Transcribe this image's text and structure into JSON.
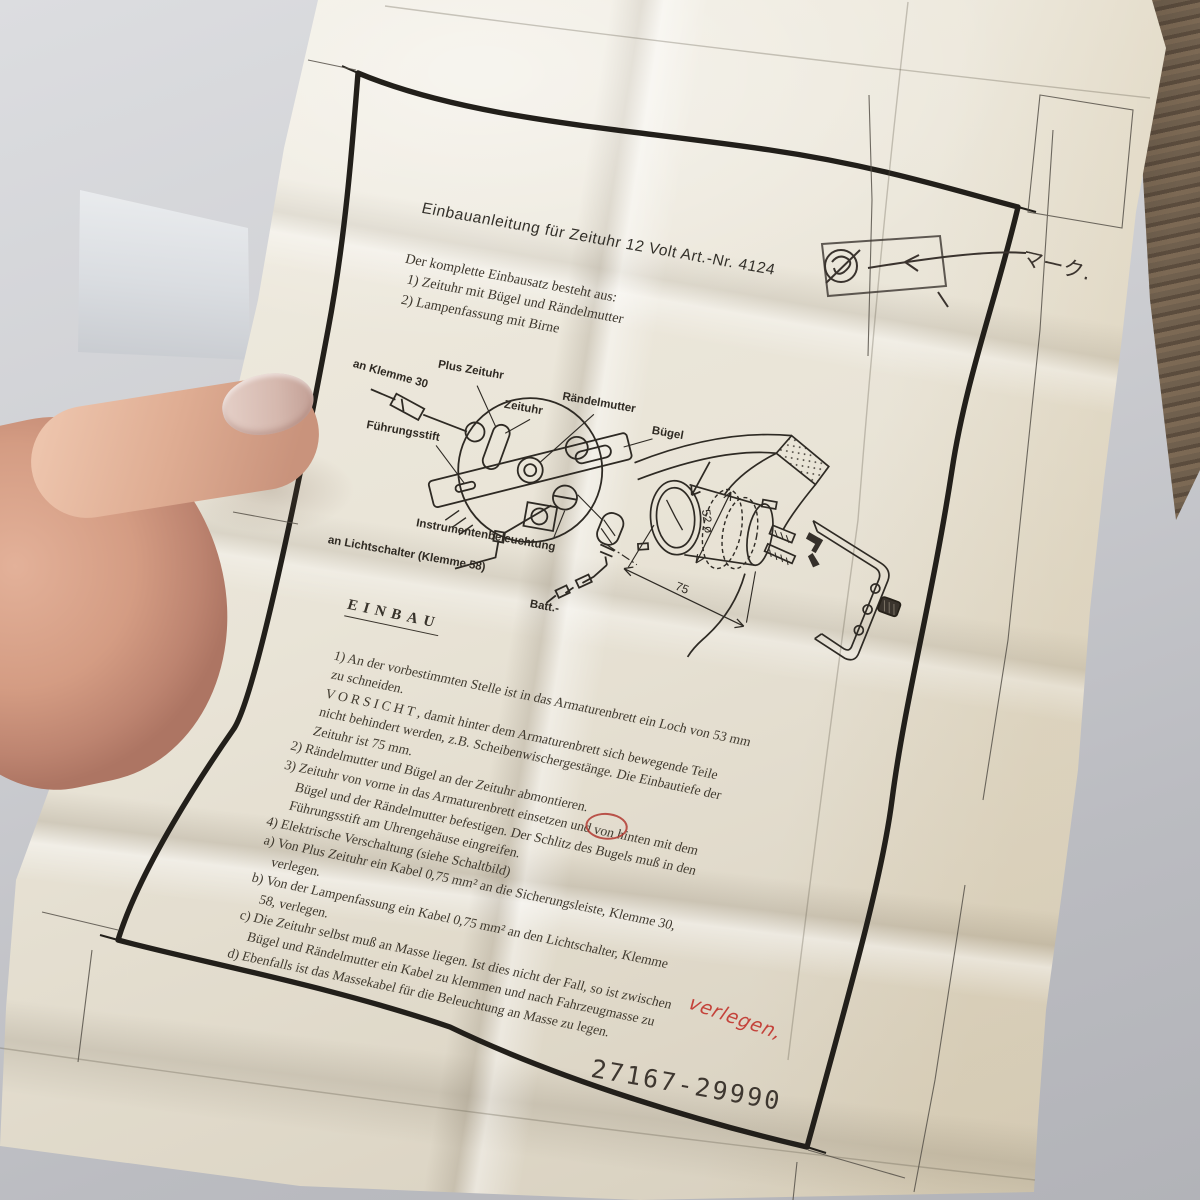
{
  "photo": {
    "background": {
      "wood": "#948b80",
      "wood_dark": "#5d4f42",
      "table": "#cbccd0",
      "shelf_face": "#e4e7ea"
    },
    "paper_color": "#e9e4d7",
    "ink_color": "#353029",
    "red_ink": "#c2403a"
  },
  "doc": {
    "title": "Einbauanleitung für Zeituhr 12 Volt Art.-Nr. 4124",
    "intro_lines": [
      "Der komplette Einbausatz besteht aus:",
      "  1) Zeituhr mit Bügel und Rändelmutter",
      "  2) Lampenfassung mit Birne"
    ],
    "diagram": {
      "labels": {
        "plus_zeituhr": "Plus Zeituhr",
        "an_klemme_30": "an Klemme 30",
        "zeituhr": "Zeituhr",
        "raendelmutter": "Rändelmutter",
        "buegel": "Bügel",
        "fuehrungsstift": "Führungsstift",
        "instrumentenbeleuchtung": "Instrumentenbeleuchtung",
        "an_lichtschalter": "an Lichtschalter (Klemme 58)",
        "batt": "Batt.-"
      },
      "dim_diameter": "52 ø",
      "dim_depth": "75"
    },
    "einbau": {
      "heading": "EINBAU",
      "lines": [
        "1) An der vorbestimmten Stelle ist in das Armaturenbrett ein Loch von 53 mm",
        "     zu schneiden.",
        "     V O R S I C H T , damit hinter dem Armaturenbrett sich bewegende Teile",
        "     nicht behindert werden, z.B. Scheibenwischergestänge. Die Einbautiefe der",
        "     Zeituhr ist 75 mm.",
        "2) Rändelmutter und Bügel an der Zeituhr abmontieren.",
        "3) Zeituhr von vorne in das Armaturenbrett einsetzen und von hinten mit dem",
        "     Bügel und der Rändelmutter befestigen. Der Schlitz des Bugels muß in den",
        "     Führungsstift am Uhrengehäuse eingreifen.",
        "4) Elektrische Verschaltung (siehe Schaltbild)",
        " a) Von Plus Zeituhr ein Kabel 0,75 mm² an die Sicherungsleiste, Klemme 30,",
        "     verlegen.",
        " b) Von der Lampenfassung ein Kabel 0,75 mm² an den Lichtschalter, Klemme",
        "     58, verlegen.",
        " c) Die Zeituhr selbst muß an Masse liegen. Ist dies nicht der Fall, so ist zwischen",
        "     Bügel und Rändelmutter ein Kabel zu klemmen und nach Fahrzeugmasse zu",
        " d) Ebenfalls ist das Massekabel für die Beleuchtung an Masse zu legen."
      ]
    },
    "handwritten": {
      "katakana_note": "マーク.",
      "red_word": "verlegen,",
      "part_number": "27167-29990"
    }
  }
}
